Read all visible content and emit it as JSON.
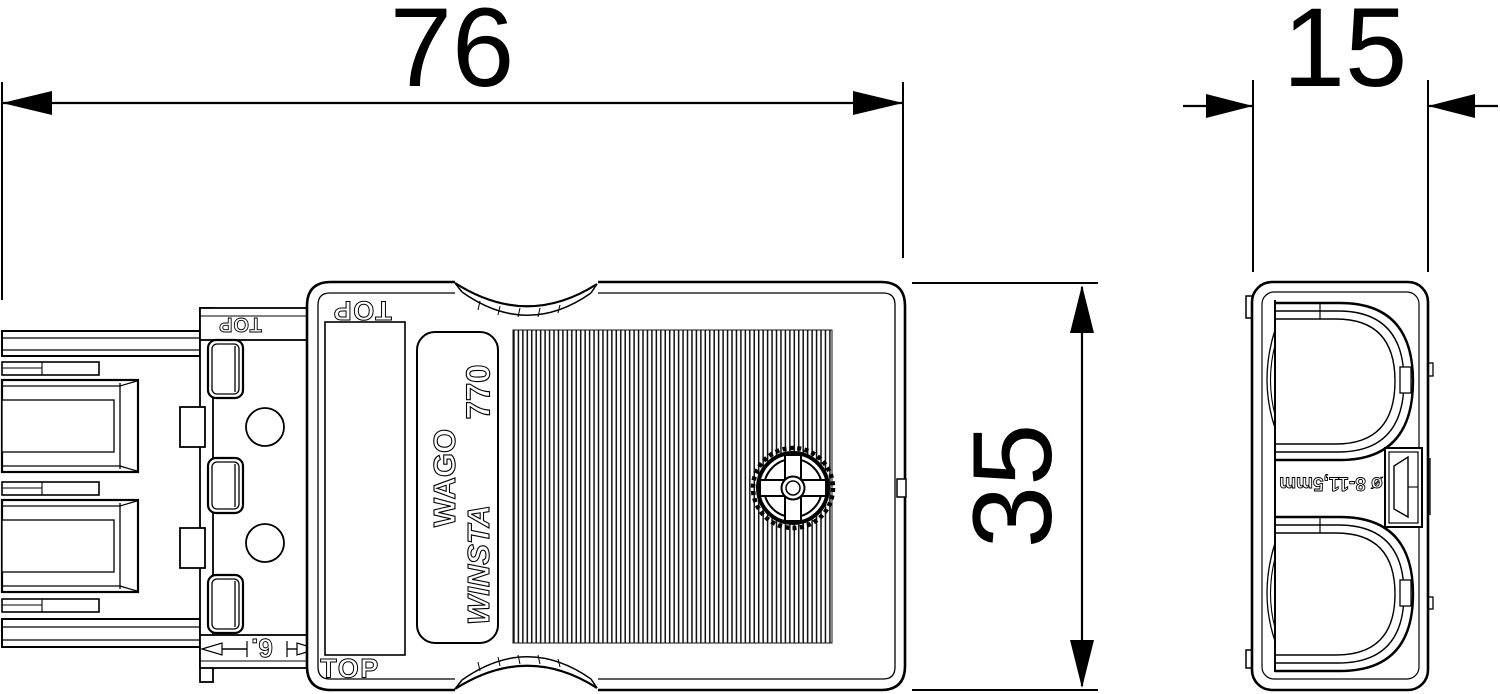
{
  "drawing": {
    "type": "technical-dimension-drawing",
    "part": "WAGO WINSTA 770 connector",
    "units_shown": "mm"
  },
  "dimensions": {
    "width_label": "76",
    "side_width_label": "15",
    "height_label": "35",
    "flange_label": "6."
  },
  "body_markings": {
    "top_upper": "TOP",
    "top_lower": "TOP",
    "top_flange": "TOP",
    "brand": "WAGO",
    "model": "770",
    "series": "WINSTA"
  },
  "side_markings": {
    "cable_range": "ø 8-11,5mm"
  },
  "colors": {
    "line": "#000000",
    "background": "#ffffff"
  }
}
